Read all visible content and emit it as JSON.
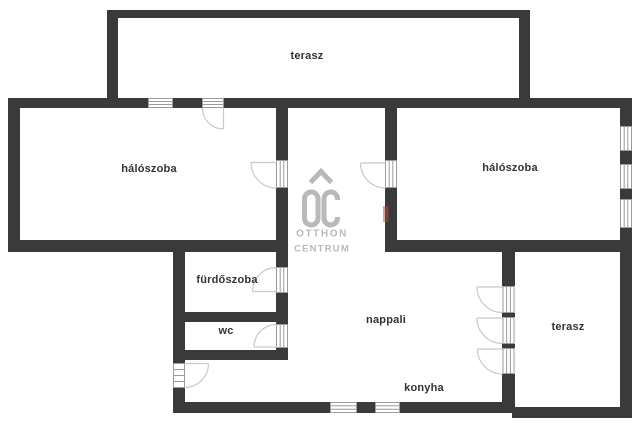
{
  "plan": {
    "background_color": "#ffffff",
    "wall_color": "#3a3a3a",
    "window_frame_color": "#9b9b9b",
    "door_arc_color": "#c9c9c9",
    "label_color": "#333333",
    "watermark_color": "#b9b9b9",
    "accent_mark_color": "#b05030",
    "rooms": [
      {
        "id": "terasz-top",
        "label": "terasz"
      },
      {
        "id": "haloszoba-left",
        "label": "hálószoba"
      },
      {
        "id": "haloszoba-right",
        "label": "hálószoba"
      },
      {
        "id": "furdoszoba",
        "label": "fürdőszoba"
      },
      {
        "id": "wc",
        "label": "wc"
      },
      {
        "id": "nappali",
        "label": "nappali"
      },
      {
        "id": "konyha",
        "label": "konyha"
      },
      {
        "id": "terasz-right",
        "label": "terasz"
      }
    ],
    "watermark": {
      "brand_initials": "OC",
      "brand_line1": "OTTHON",
      "brand_line2": "CENTRUM"
    }
  }
}
